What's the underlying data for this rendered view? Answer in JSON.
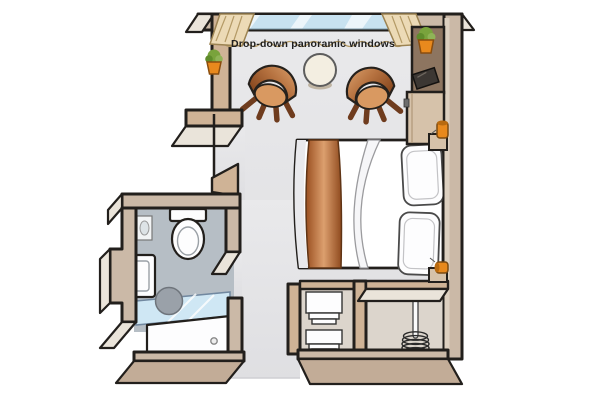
{
  "labels": {
    "windows": "Drop-down panoramic windows"
  },
  "items": [
    "drop-down panoramic windows",
    "curtains",
    "armchair (left)",
    "armchair (right)",
    "side table",
    "double bed with runner",
    "pillows",
    "reading lamps",
    "bedside shelves",
    "tall cabinet with TV",
    "lowboard cabinet",
    "potted plant (left wall)",
    "potted plant (cabinet)",
    "toilet",
    "wall mirror",
    "vanity unit with plant",
    "round washbasin",
    "shower with glass screen",
    "wardrobe shelves",
    "wardrobe hanging rail with hangers",
    "entrance opening"
  ],
  "colors": {
    "outline": "#221f1c",
    "wallFace": "#cfb396",
    "wallSide": "#cbb9a7",
    "wallTop": "#eae4da",
    "slab": "#c2ac97",
    "floor": "#e4e4e6",
    "floorLine": "#cfcfd3",
    "bathFloor": "#b6bec5",
    "closetFloor": "#dcd5cc",
    "windowBlue": "#c8e2f0",
    "glassBlue": "#cfe7f4",
    "curtain": "#ecdab6",
    "curtainLine": "#b49a66",
    "chairDark": "#8e4a1f",
    "chairLight": "#d99961",
    "chairLeg": "#6f3c1e",
    "tableTop": "#f3eee1",
    "runnerDark": "#9a4f20",
    "runnerLight": "#dc9f6e",
    "pillow": "#fdfdfe",
    "potOrange": "#e8891d",
    "leafGreen": "#79a33c",
    "lampOrange": "#e8891d",
    "tvDark": "#3c3733",
    "cabinetDark": "#8d7560",
    "cabinetLight": "#d6c2aa",
    "basinGray": "#9aa1a9",
    "text": "#1f1f1f"
  }
}
